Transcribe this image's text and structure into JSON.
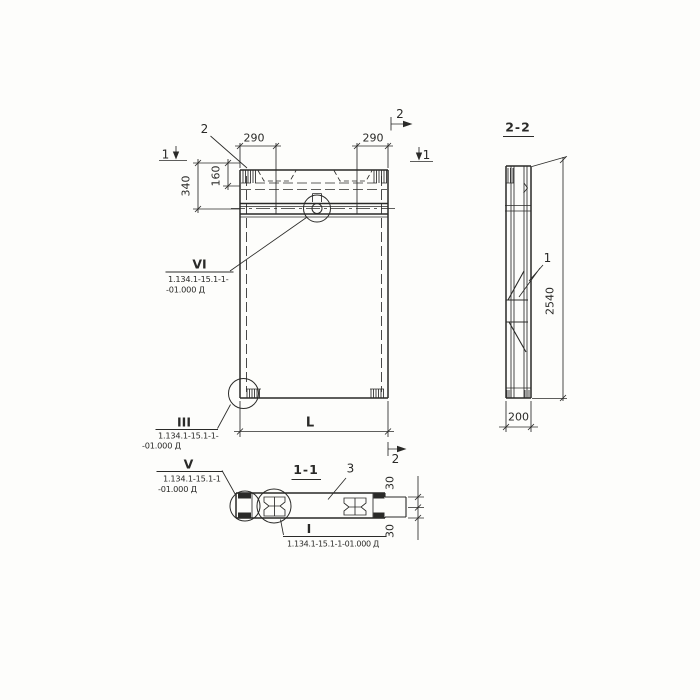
{
  "page_bg": "#fdfdfb",
  "drawing_ink": "#2a2a28",
  "main_view": {
    "leader_2_label": "2",
    "dim_290_left": "290",
    "dim_290_right": "290",
    "dim_340": "340",
    "dim_160": "160",
    "dim_length": "L",
    "cut_1_left": "1",
    "cut_1_right": "1",
    "cut_2_top": "2",
    "cut_2_bottom": "2"
  },
  "side_view": {
    "title": "2-2",
    "dim_height": "2540",
    "dim_width": "200",
    "leader_1_label": "1"
  },
  "section_view": {
    "title": "1-1",
    "leader_3_label": "3",
    "dim_30_top": "30",
    "dim_30_bottom": "30"
  },
  "callouts": {
    "vi": {
      "numeral": "VI",
      "ref_line1": "1.134.1-15.1-1-",
      "ref_line2": "-01.000 Д"
    },
    "iii": {
      "numeral": "III",
      "ref_line1": "1.134.1-15.1-1-",
      "ref_line2": "-01.000 Д"
    },
    "v": {
      "numeral": "V",
      "ref_line1": "1.134.1-15.1-1",
      "ref_line2": "-01.000 Д"
    },
    "i": {
      "numeral": "I",
      "ref": "1.134.1-15.1-1-01.000 Д"
    }
  }
}
